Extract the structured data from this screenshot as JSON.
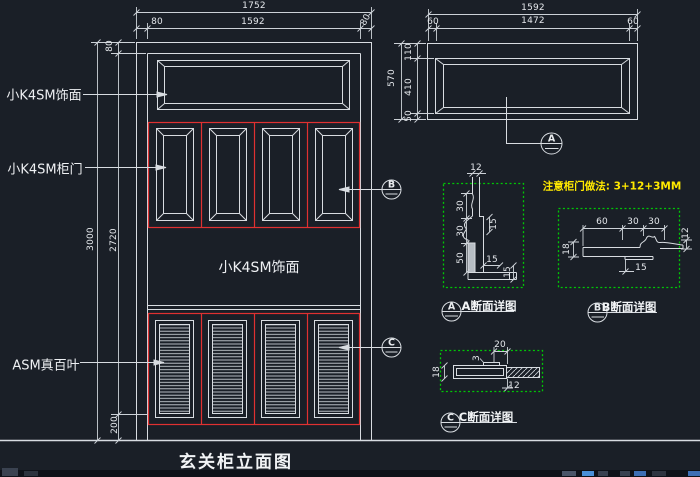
{
  "title": "玄关柜立面图",
  "elev": {
    "dim_total_w": "1752",
    "dim_margin_l": "80",
    "dim_inner_w": "1592",
    "dim_margin_r": "80",
    "dim_top": "80",
    "dim_total_h": "3000",
    "dim_inner_h": "2720",
    "dim_base": "200",
    "label_top_veneer": "小K4SM饰面",
    "label_door": "小K4SM柜门",
    "label_mid_veneer": "小K4SM饰面",
    "label_louver": "ASM真百叶",
    "marker_b": "B",
    "marker_c": "C"
  },
  "panel": {
    "dim_total_w": "1592",
    "dim_l": "60",
    "dim_inner_w": "1472",
    "dim_r": "60",
    "dim_total_h": "570",
    "dim_top": "110",
    "dim_mid": "410",
    "dim_bot": "50",
    "marker": "A"
  },
  "note": "注意柜门做法: 3+12+3MM",
  "detail_a": {
    "marker": "A",
    "label": "A断面详图",
    "d12": "12",
    "d30a": "30",
    "d30b": "30",
    "d50": "50",
    "d15a": "15",
    "d15b": "15",
    "d15c": "15"
  },
  "detail_b": {
    "marker": "B",
    "label": "B断面详图",
    "d60": "60",
    "d30a": "30",
    "d30b": "30",
    "d18": "18",
    "d15": "15",
    "d12": "12"
  },
  "detail_c": {
    "marker": "C",
    "label": "C断面详图",
    "d20": "20",
    "d3": "3",
    "d18": "18",
    "d12": "12"
  }
}
